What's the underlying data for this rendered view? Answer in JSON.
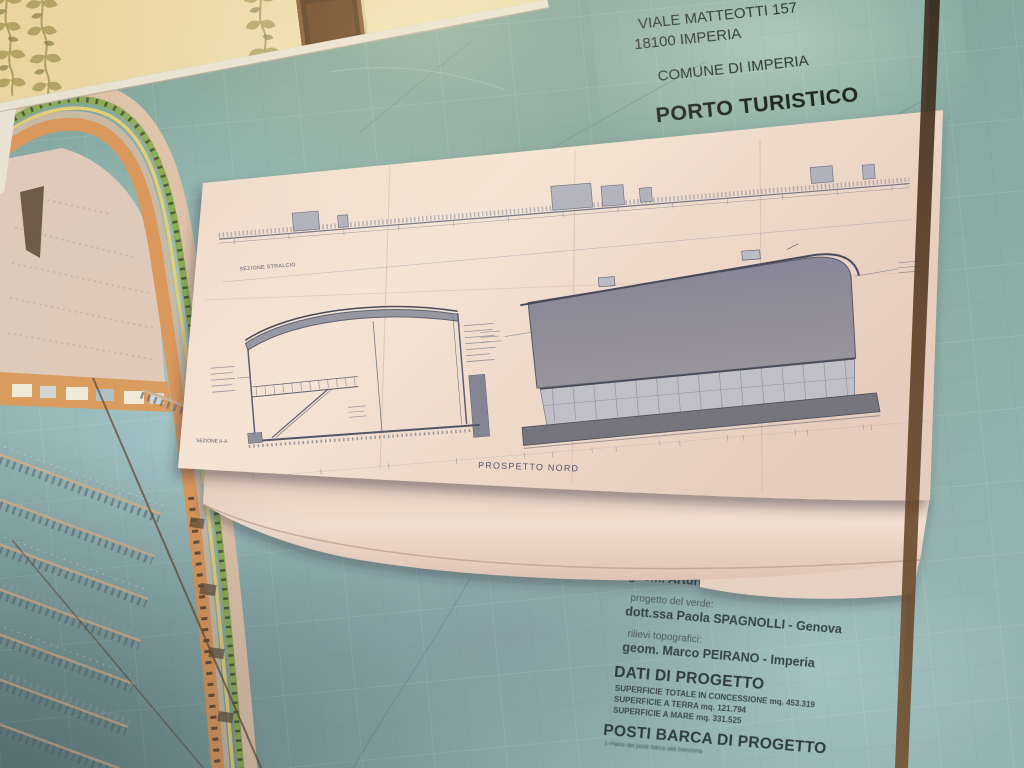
{
  "poster_header": {
    "title": "PORTO DI IMPERIA",
    "address_line1": "VIALE MATTEOTTI 157",
    "address_line2": "18100 IMPERIA",
    "municipality": "COMUNE DI IMPERIA",
    "subtitle": "PORTO TURISTICO"
  },
  "credits": {
    "role1": "coordinamento e sicurezza:",
    "name1": "geom. Arturo CIPRIANI - Imperia",
    "role2": "progetto del verde:",
    "name2": "dott.ssa  Paola SPAGNOLLI - Genova",
    "role3": "rilievi topografici:",
    "name3": "geom. Marco PEIRANO - Imperia"
  },
  "project_data": {
    "heading": "DATI DI PROGETTO",
    "surface_total": "SUPERFICIE TOTALE IN CONCESSIONE  mq. 453.319",
    "surface_land": "SUPERFICIE A TERRA  mq. 121.794",
    "surface_sea": "SUPERFICIE A MARE   mq. 331.525",
    "heading2": "POSTI BARCA DI PROGETTO",
    "fineprint": "1-Piano dei posti barca alla banchina"
  },
  "drawing_sheet": {
    "label_top_strip": "SEZIONE STRALCIO",
    "label_section": "SEZIONE A-A",
    "label_elevation": "PROSPETTO NORD"
  },
  "colors": {
    "board_teal": "#7ca59c",
    "sea_cyan": "#a7d3da",
    "sea_gray": "#85a0b2",
    "quay_orange": "#dd9555",
    "greenery": "#86ac50",
    "wall_cream": "#ecdca6",
    "wall_orange": "#c4722e",
    "paper": "#f0ddd0",
    "ink_blue": "#6b7288"
  }
}
